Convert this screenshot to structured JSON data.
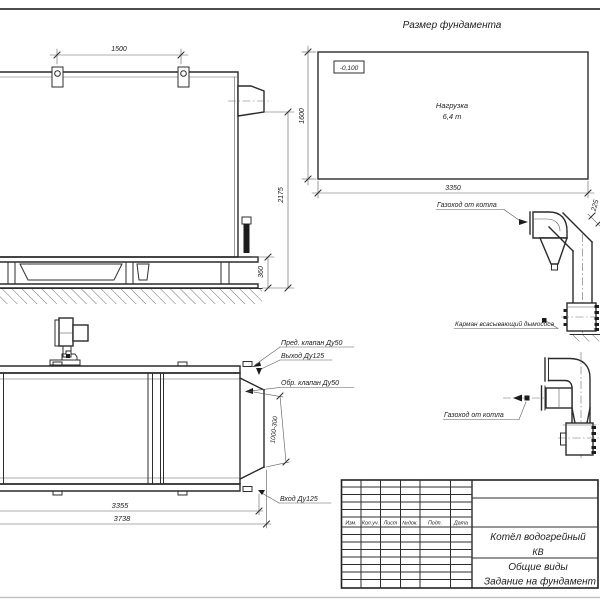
{
  "foundation": {
    "title": "Размер фундамента",
    "elevation": "-0,100",
    "load_line1": "Нагрузка",
    "load_line2": "6,4 т",
    "dim_width": "3350",
    "dim_depth": "1600"
  },
  "side_view": {
    "dim_lug_spacing": "1500",
    "dim_height": "2175",
    "dim_base_height": "360"
  },
  "duct_upper": {
    "label": "Газоход от котла",
    "dim_offset": "225",
    "pocket_label": "Карман всасывающий дымососа"
  },
  "duct_lower": {
    "label": "Газоход от котла"
  },
  "top_view": {
    "label_safety_valve": "Пред. клапан Ду50",
    "label_outlet": "Выход Ду125",
    "label_check_valve": "Обр. клапан Ду50",
    "label_inlet": "Вход Ду125",
    "dim_range": "1000-300",
    "dim_body_length": "3355",
    "dim_total_length": "3738"
  },
  "title_block": {
    "columns": [
      "Изм.",
      "Кол.уч.",
      "Лист",
      "№док.",
      "Подп.",
      "Дата"
    ],
    "product_line1": "Котёл водогрейный",
    "product_line2": "КВ",
    "doc_line1": "Общие виды",
    "doc_line2": "Задание на фундамент"
  }
}
